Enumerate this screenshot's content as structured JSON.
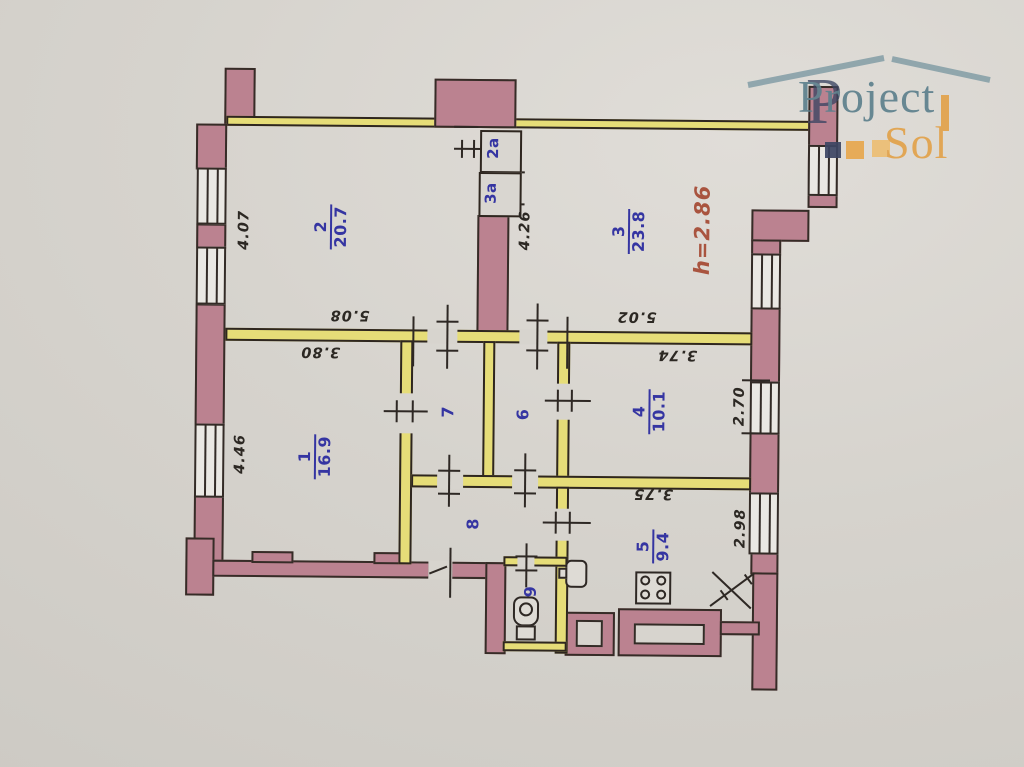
{
  "document": {
    "type": "apartment floor plan (BTI technical drawing)"
  },
  "ceiling_height": "h=2.86",
  "rooms": [
    {
      "number": "1",
      "area": "16.9"
    },
    {
      "number": "2",
      "area": "20.7"
    },
    {
      "number": "3",
      "area": "23.8"
    },
    {
      "number": "4",
      "area": "10.1"
    },
    {
      "number": "5",
      "area": "9.4"
    },
    {
      "number": "6"
    },
    {
      "number": "7"
    },
    {
      "number": "8"
    },
    {
      "number": "9"
    },
    {
      "number": "2a"
    },
    {
      "number": "3a"
    }
  ],
  "dimensions": [
    "4.07",
    "4.46",
    "4.26",
    "5.08",
    "5.02",
    "3.80",
    "3.74",
    "3.75",
    "2.70",
    "2.98"
  ],
  "logo": {
    "brand_top": "Project",
    "brand_bottom": "Sol",
    "mark_letter": "P"
  },
  "colors": {
    "wall_pink": "#bb8290",
    "partition_yellow": "#e6dd78",
    "room_label_blue": "#3535a2",
    "dimension_black": "#2c2823",
    "height_note_red": "#a9543f",
    "logo_teal": "#5d808d",
    "logo_orange": "#e2a24b",
    "paper": "#d6d3cd"
  }
}
